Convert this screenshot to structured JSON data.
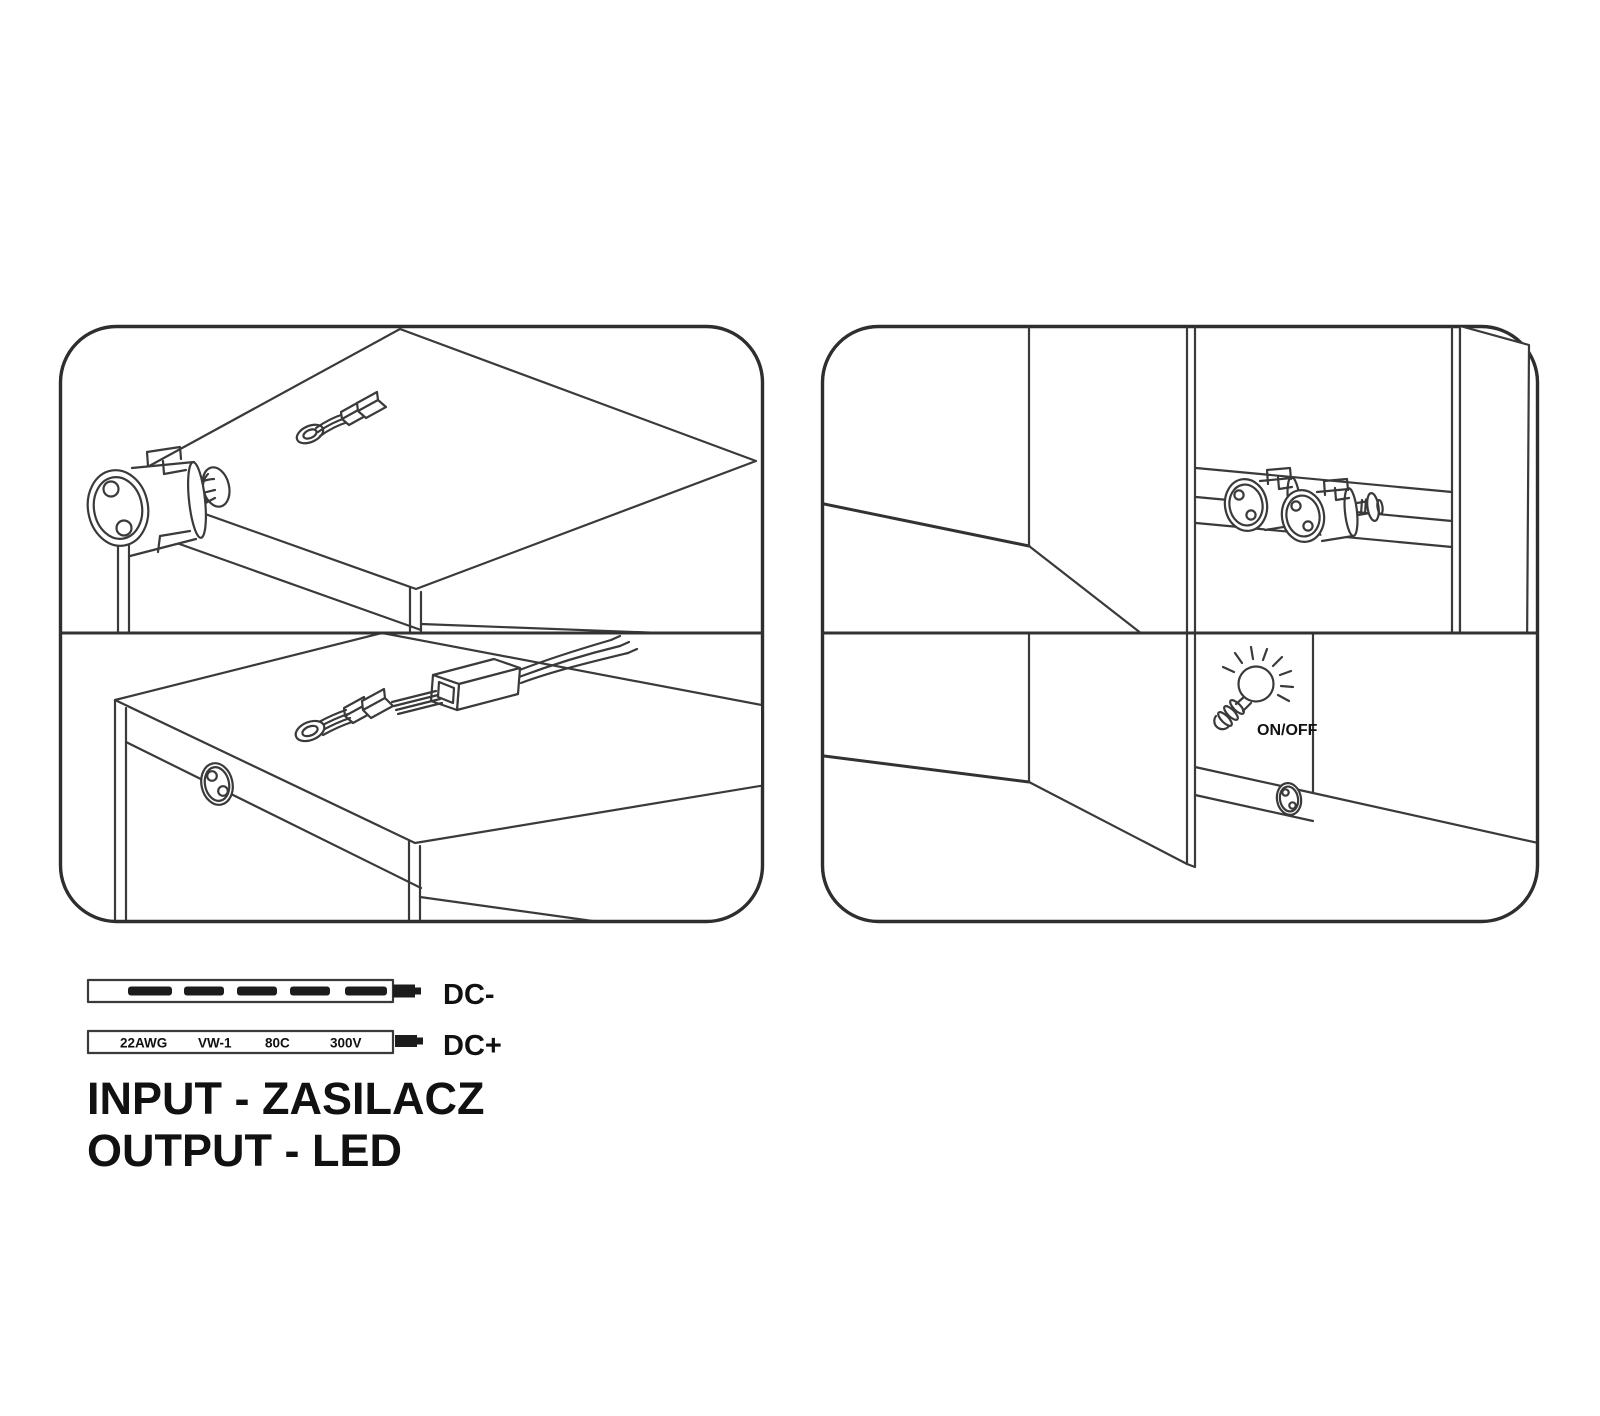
{
  "document": {
    "kind": "LED furniture connector installation diagram",
    "background_color": "#ffffff",
    "line_color": "#3a3a3a",
    "text_color": "#111111"
  },
  "icons": [
    {
      "name": "snap-in-connector-icon",
      "desc": "cylindrical 2-pin plug inserted through cabinet side hole"
    },
    {
      "name": "cable-connector-icon",
      "desc": "small ribbon cable with plug on cabinet top"
    },
    {
      "name": "socket-icon",
      "desc": "round 2-hole socket on cabinet front"
    },
    {
      "name": "coupler-cable-icon",
      "desc": "plug entering coupler box with three output wires"
    },
    {
      "name": "connector-pair-icon",
      "desc": "two cylindrical connectors meeting on cabinet rail"
    },
    {
      "name": "light-bulb-icon",
      "desc": "shining bulb marking switch position"
    }
  ],
  "switch": {
    "label": "ON/OFF"
  },
  "wires": {
    "dc_minus": {
      "label": "DC-"
    },
    "dc_plus": {
      "label": "DC+",
      "markings": [
        "22AWG",
        "VW-1",
        "80C",
        "300V"
      ]
    }
  },
  "captions": {
    "input": "INPUT - ZASILACZ",
    "output": "OUTPUT - LED"
  }
}
